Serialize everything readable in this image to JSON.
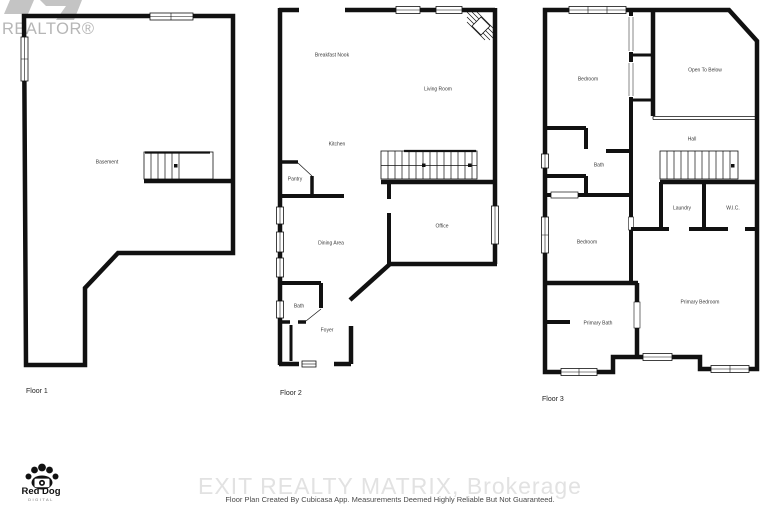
{
  "branding": {
    "realtor_text": "REALTOR®",
    "watermark": "EXIT REALTY MATRIX, Brokerage",
    "disclaimer": "Floor Plan Created By Cubicasa App. Measurements Deemed Highly Reliable But Not Guaranteed.",
    "red_dog": {
      "name": "Red Dog",
      "sub": "DIGITAL"
    }
  },
  "floors": [
    {
      "caption": "Floor 1",
      "rooms": [
        {
          "label": "Basement"
        }
      ]
    },
    {
      "caption": "Floor 2",
      "rooms": [
        {
          "label": "Breakfast Nook"
        },
        {
          "label": "Living Room"
        },
        {
          "label": "Kitchen"
        },
        {
          "label": "Pantry"
        },
        {
          "label": "Dining Area"
        },
        {
          "label": "Office"
        },
        {
          "label": "Bath"
        },
        {
          "label": "Foyer"
        }
      ]
    },
    {
      "caption": "Floor 3",
      "rooms": [
        {
          "label": "Bedroom"
        },
        {
          "label": "Open To Below"
        },
        {
          "label": "Hall"
        },
        {
          "label": "Bath"
        },
        {
          "label": "Laundry"
        },
        {
          "label": "W.I.C."
        },
        {
          "label": "Bedroom"
        },
        {
          "label": "Primary Bedroom"
        },
        {
          "label": "Primary Bath"
        }
      ]
    }
  ],
  "colors": {
    "walls": "#111111",
    "watermark_gray": "#e2e2e2",
    "realtor_gray": "#b6b6b6",
    "label_text": "#3a3a3a"
  }
}
